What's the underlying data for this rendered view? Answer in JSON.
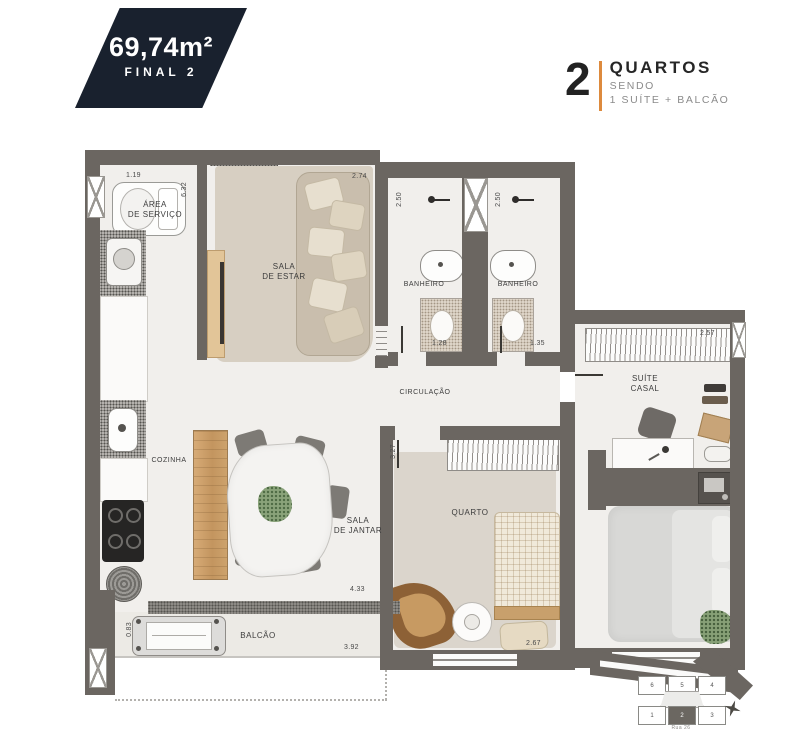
{
  "badge": {
    "area": "69,74m²",
    "final": "FINAL 2"
  },
  "legend": {
    "number": "2",
    "title": "QUARTOS",
    "subtitle1": "SENDO",
    "subtitle2": "1 SUÍTE + BALCÃO"
  },
  "rooms": {
    "area_servico": "ÁREA\nDE SERVIÇO",
    "sala_estar": "SALA\nDE ESTAR",
    "banheiro1": "BANHEIRO",
    "banheiro2": "BANHEIRO",
    "circulacao": "CIRCULAÇÃO",
    "cozinha": "COZINHA",
    "sala_jantar": "SALA\nDE JANTAR",
    "quarto": "QUARTO",
    "suite_casal": "SUÍTE\nCASAL",
    "balcao": "BALCÃO"
  },
  "dimensions": {
    "servico_w": "1.19",
    "servico_h": "6.32",
    "estar_w": "2.74",
    "banheiro1_h": "2.50",
    "banheiro2_h": "2.50",
    "banheiro1_w": "1.28",
    "banheiro2_w": "1.35",
    "suite_w": "2.57",
    "quarto_h": "3.27",
    "quarto_w": "2.67",
    "jantar_w": "4.33",
    "balcao_w": "3.92",
    "balcao_h": "0.83"
  },
  "keyplan": {
    "top": [
      "6",
      "5",
      "4"
    ],
    "bottom": [
      "1",
      "2",
      "3"
    ],
    "highlighted_unit": "2",
    "caption": "Rua 26"
  },
  "colors": {
    "badge_bg": "#19212e",
    "accent_orange": "#dd8a3d",
    "wall_gray": "#6b6661"
  }
}
